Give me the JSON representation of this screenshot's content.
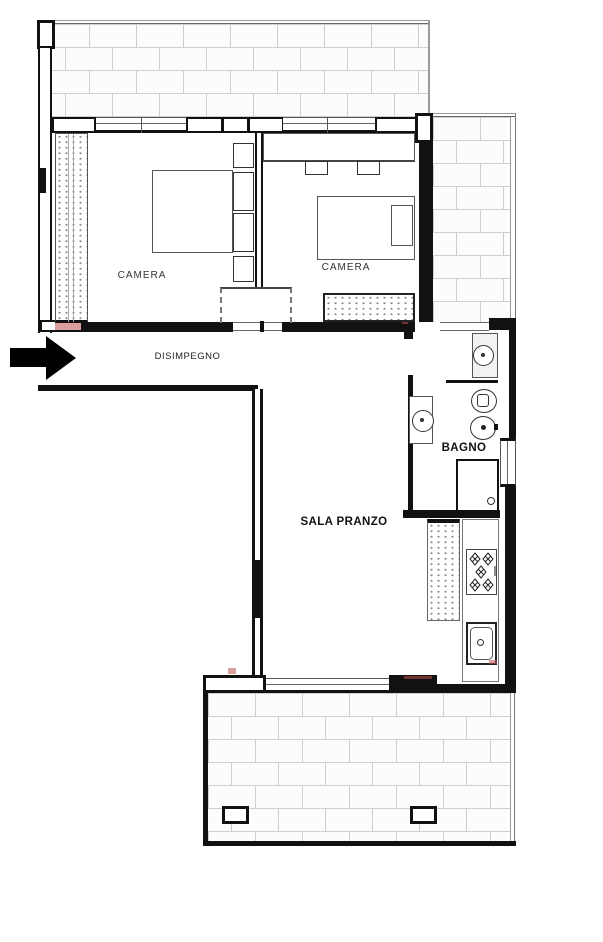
{
  "title": "Apartment floor plan",
  "rooms": {
    "camera_left": {
      "label": "CAMERA"
    },
    "camera_right": {
      "label": "CAMERA"
    },
    "hallway": {
      "label": "DISIMPEGNO"
    },
    "bathroom": {
      "label": "BAGNO"
    },
    "dining": {
      "label": "SALA PRANZO"
    }
  },
  "entrance": {
    "icon": "entrance-arrow",
    "direction": "right"
  },
  "icons": {
    "entrance": "entrance-arrow",
    "bed_double": "double-bed",
    "bed_single": "single-bed",
    "wardrobe": "wardrobe-dotted",
    "radiator": "radiator-dotted",
    "washbasin": "washbasin-round",
    "toilet": "wc",
    "bidet": "bidet",
    "shower": "shower-tray",
    "stove": "gas-hob-5-burners",
    "kitchen_sink": "kitchen-sink",
    "terrace": "brick-hatch"
  },
  "colors": {
    "wall": "#111111",
    "furniture_line": "#555555",
    "brick_line": "#cfcfcf",
    "brick_fill": "#fcfcfc",
    "dots": "#8a8a8a",
    "accent_red": "#c0504d",
    "background": "#ffffff",
    "text": "#222222"
  }
}
